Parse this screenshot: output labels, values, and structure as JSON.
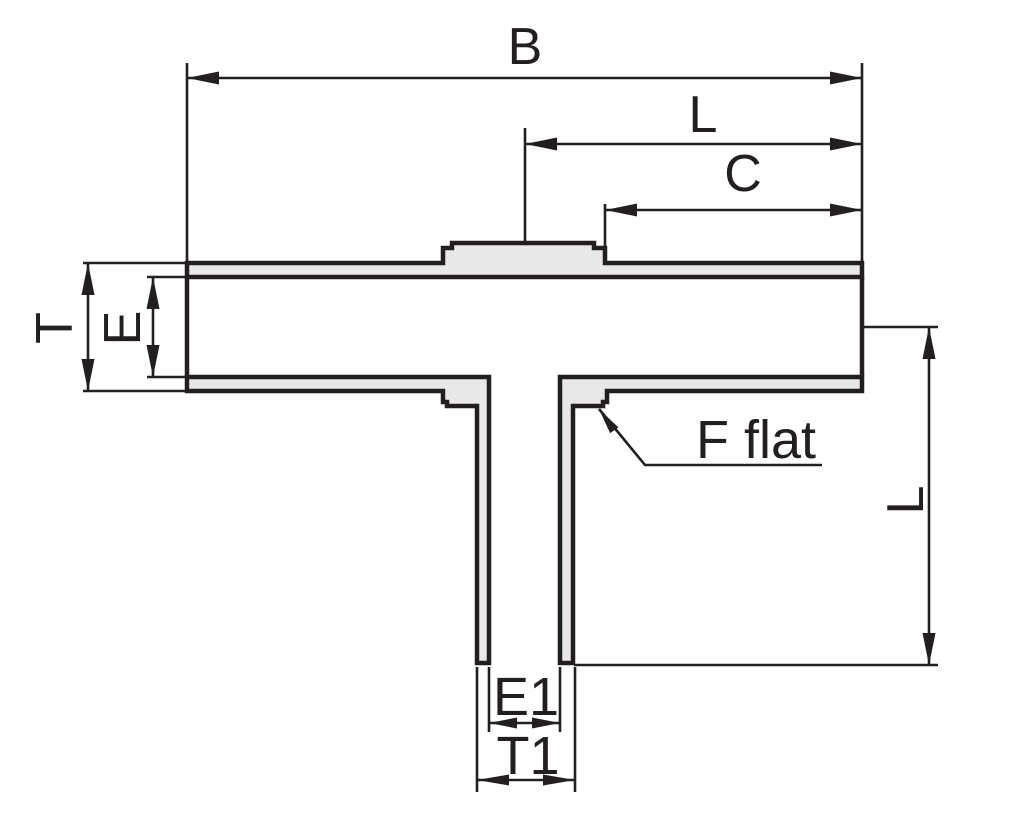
{
  "drawing": {
    "kind": "tee-fitting-cross-section-dimension-diagram",
    "colors": {
      "line": "#231f20",
      "fill": "#e8e8e8",
      "background": "#ffffff"
    },
    "labels": {
      "b": "B",
      "l_top": "L",
      "c": "C",
      "t": "T",
      "e": "E",
      "f_flat": "F flat",
      "l_right": "L",
      "e1": "E1",
      "t1": "T1"
    }
  }
}
